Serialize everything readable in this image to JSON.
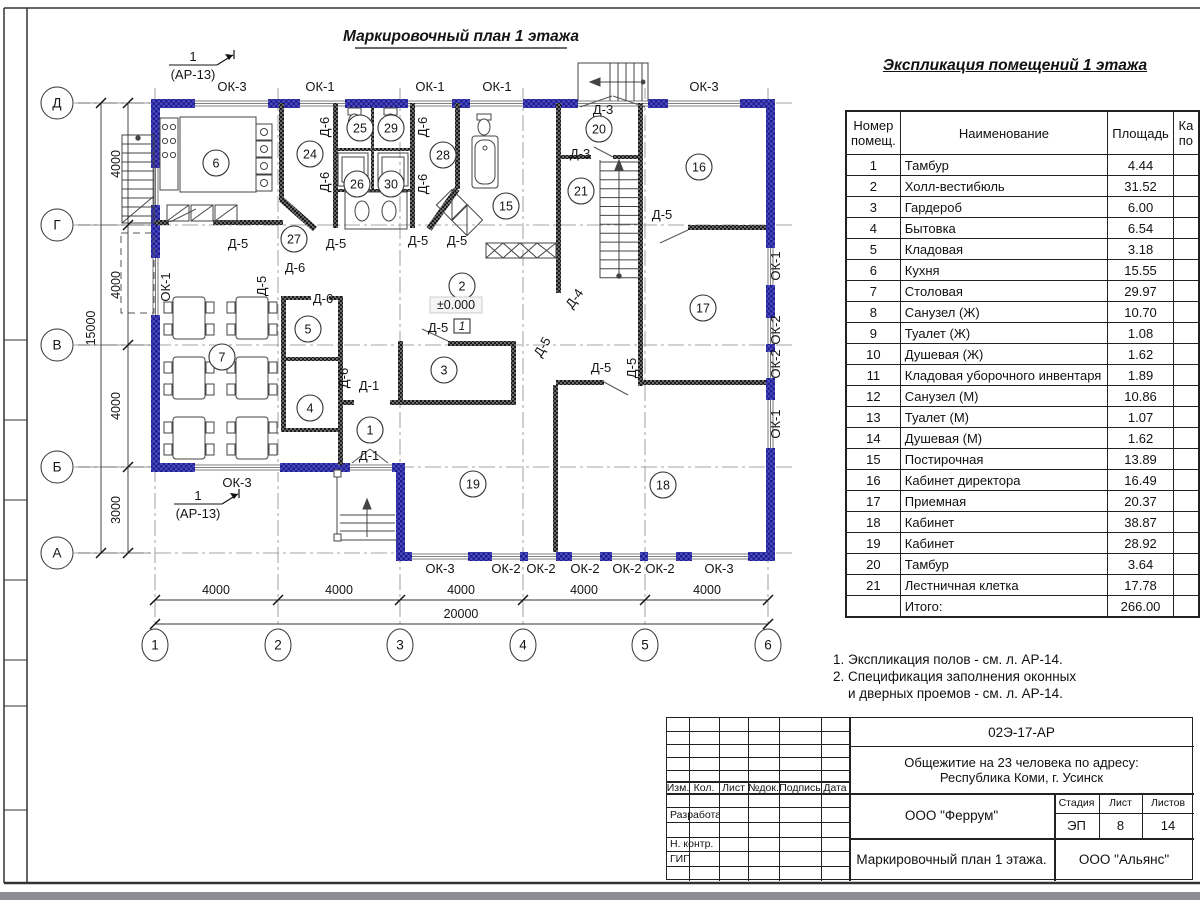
{
  "plan": {
    "title": "Маркировочный план 1 этажа",
    "section_markers": [
      {
        "num": "1",
        "ref": "(АР-13)",
        "x": 193,
        "y": 58
      },
      {
        "num": "1",
        "ref": "(АР-13)",
        "x": 198,
        "y": 497
      }
    ],
    "elevation_mark": {
      "text": "±0.000",
      "x": 456,
      "y": 309
    },
    "floor_number_box": {
      "text": "1",
      "x": 462,
      "y": 330
    },
    "axes_rows": [
      {
        "label": "Д",
        "y": 103
      },
      {
        "label": "Г",
        "y": 225
      },
      {
        "label": "В",
        "y": 345
      },
      {
        "label": "Б",
        "y": 467
      },
      {
        "label": "А",
        "y": 553
      }
    ],
    "axes_cols": [
      {
        "label": "1",
        "x": 155
      },
      {
        "label": "2",
        "x": 278
      },
      {
        "label": "3",
        "x": 400
      },
      {
        "label": "4",
        "x": 523
      },
      {
        "label": "5",
        "x": 645
      },
      {
        "label": "6",
        "x": 768
      }
    ],
    "dims_left": [
      {
        "text": "4000",
        "y": 164
      },
      {
        "text": "4000",
        "y": 285
      },
      {
        "text": "4000",
        "y": 406
      },
      {
        "text": "3000",
        "y": 510
      }
    ],
    "dim_left_total": {
      "text": "15000",
      "y": 328
    },
    "dims_bottom": [
      {
        "text": "4000",
        "x": 216
      },
      {
        "text": "4000",
        "x": 339
      },
      {
        "text": "4000",
        "x": 461
      },
      {
        "text": "4000",
        "x": 584
      },
      {
        "text": "4000",
        "x": 707
      }
    ],
    "dim_bottom_total": {
      "text": "20000",
      "x": 461
    },
    "window_labels": [
      {
        "text": "ОК-3",
        "x": 232,
        "y": 91,
        "r": 0
      },
      {
        "text": "ОК-1",
        "x": 320,
        "y": 91,
        "r": 0
      },
      {
        "text": "ОК-1",
        "x": 430,
        "y": 91,
        "r": 0
      },
      {
        "text": "ОК-1",
        "x": 497,
        "y": 91,
        "r": 0
      },
      {
        "text": "ОК-3",
        "x": 704,
        "y": 91,
        "r": 0
      },
      {
        "text": "ОК-3",
        "x": 237,
        "y": 487,
        "r": 0
      },
      {
        "text": "ОК-3",
        "x": 440,
        "y": 573,
        "r": 0
      },
      {
        "text": "ОК-2",
        "x": 506,
        "y": 573,
        "r": 0
      },
      {
        "text": "ОК-2",
        "x": 541,
        "y": 573,
        "r": 0
      },
      {
        "text": "ОК-2",
        "x": 585,
        "y": 573,
        "r": 0
      },
      {
        "text": "ОК-2",
        "x": 627,
        "y": 573,
        "r": 0
      },
      {
        "text": "ОК-2",
        "x": 660,
        "y": 573,
        "r": 0
      },
      {
        "text": "ОК-3",
        "x": 719,
        "y": 573,
        "r": 0
      },
      {
        "text": "ОК-1",
        "x": 170,
        "y": 287,
        "r": -90
      },
      {
        "text": "ОК-1",
        "x": 780,
        "y": 266,
        "r": -90
      },
      {
        "text": "ОК-2",
        "x": 780,
        "y": 330,
        "r": -90
      },
      {
        "text": "ОК-2",
        "x": 780,
        "y": 364,
        "r": -90
      },
      {
        "text": "ОК-1",
        "x": 780,
        "y": 424,
        "r": -90
      }
    ],
    "door_labels": [
      {
        "text": "Д-6",
        "x": 329,
        "y": 127,
        "r": -90
      },
      {
        "text": "Д-6",
        "x": 427,
        "y": 127,
        "r": -90
      },
      {
        "text": "Д-6",
        "x": 329,
        "y": 182,
        "r": -90
      },
      {
        "text": "Д-6",
        "x": 427,
        "y": 184,
        "r": -90
      },
      {
        "text": "Д-3",
        "x": 603,
        "y": 114,
        "r": 0
      },
      {
        "text": "Д-3",
        "x": 580,
        "y": 158,
        "r": 0
      },
      {
        "text": "Д-5",
        "x": 662,
        "y": 219,
        "r": 0
      },
      {
        "text": "Д-5",
        "x": 238,
        "y": 248,
        "r": 0
      },
      {
        "text": "Д-5",
        "x": 336,
        "y": 248,
        "r": 0
      },
      {
        "text": "Д-5",
        "x": 418,
        "y": 245,
        "r": 0
      },
      {
        "text": "Д-5",
        "x": 457,
        "y": 245,
        "r": 0
      },
      {
        "text": "Д-6",
        "x": 295,
        "y": 272,
        "r": 0
      },
      {
        "text": "Д-5",
        "x": 266,
        "y": 286,
        "r": -90
      },
      {
        "text": "Д-6",
        "x": 323,
        "y": 303,
        "r": 0
      },
      {
        "text": "Д-6",
        "x": 348,
        "y": 378,
        "r": -90
      },
      {
        "text": "Д-1",
        "x": 369,
        "y": 390,
        "r": 0
      },
      {
        "text": "Д-1",
        "x": 369,
        "y": 460,
        "r": 0
      },
      {
        "text": "Д-5",
        "x": 438,
        "y": 332,
        "r": 0
      },
      {
        "text": "Д-4",
        "x": 578,
        "y": 301,
        "r": -55
      },
      {
        "text": "Д-5",
        "x": 546,
        "y": 349,
        "r": -60
      },
      {
        "text": "Д-5",
        "x": 601,
        "y": 372,
        "r": 0
      },
      {
        "text": "Д-5",
        "x": 636,
        "y": 368,
        "r": -90
      }
    ],
    "room_markers": [
      {
        "n": "6",
        "x": 216,
        "y": 163
      },
      {
        "n": "24",
        "x": 310,
        "y": 154
      },
      {
        "n": "25",
        "x": 360,
        "y": 128
      },
      {
        "n": "29",
        "x": 391,
        "y": 128
      },
      {
        "n": "26",
        "x": 357,
        "y": 184
      },
      {
        "n": "30",
        "x": 391,
        "y": 184
      },
      {
        "n": "28",
        "x": 443,
        "y": 155
      },
      {
        "n": "27",
        "x": 294,
        "y": 239
      },
      {
        "n": "15",
        "x": 506,
        "y": 206
      },
      {
        "n": "20",
        "x": 599,
        "y": 129
      },
      {
        "n": "21",
        "x": 581,
        "y": 191
      },
      {
        "n": "16",
        "x": 699,
        "y": 167
      },
      {
        "n": "17",
        "x": 703,
        "y": 308
      },
      {
        "n": "7",
        "x": 222,
        "y": 357
      },
      {
        "n": "5",
        "x": 308,
        "y": 329
      },
      {
        "n": "4",
        "x": 310,
        "y": 408
      },
      {
        "n": "2",
        "x": 462,
        "y": 286
      },
      {
        "n": "3",
        "x": 444,
        "y": 370
      },
      {
        "n": "1",
        "x": 370,
        "y": 430
      },
      {
        "n": "19",
        "x": 473,
        "y": 484
      },
      {
        "n": "18",
        "x": 663,
        "y": 485
      }
    ]
  },
  "schedule": {
    "title": "Экспликация помещений 1 этажа",
    "col_number_l1": "Номер",
    "col_number_l2": "помещ.",
    "col_name": "Наименование",
    "col_area": "Площадь",
    "col_cut_l1": "Ка",
    "col_cut_l2": "по",
    "rows": [
      {
        "n": "1",
        "name": "Тамбур",
        "area": "4.44"
      },
      {
        "n": "2",
        "name": "Холл-вестибюль",
        "area": "31.52"
      },
      {
        "n": "3",
        "name": "Гардероб",
        "area": "6.00"
      },
      {
        "n": "4",
        "name": "Бытовка",
        "area": "6.54"
      },
      {
        "n": "5",
        "name": "Кладовая",
        "area": "3.18"
      },
      {
        "n": "6",
        "name": "Кухня",
        "area": "15.55"
      },
      {
        "n": "7",
        "name": "Столовая",
        "area": "29.97"
      },
      {
        "n": "8",
        "name": "Санузел (Ж)",
        "area": "10.70"
      },
      {
        "n": "9",
        "name": "Туалет (Ж)",
        "area": "1.08"
      },
      {
        "n": "10",
        "name": "Душевая (Ж)",
        "area": "1.62"
      },
      {
        "n": "11",
        "name": "Кладовая уборочного инвентаря",
        "area": "1.89"
      },
      {
        "n": "12",
        "name": "Санузел (М)",
        "area": "10.86"
      },
      {
        "n": "13",
        "name": "Туалет (М)",
        "area": "1.07"
      },
      {
        "n": "14",
        "name": "Душевая (М)",
        "area": "1.62"
      },
      {
        "n": "15",
        "name": "Постирочная",
        "area": "13.89"
      },
      {
        "n": "16",
        "name": "Кабинет директора",
        "area": "16.49"
      },
      {
        "n": "17",
        "name": "Приемная",
        "area": "20.37"
      },
      {
        "n": "18",
        "name": "Кабинет",
        "area": "38.87"
      },
      {
        "n": "19",
        "name": "Кабинет",
        "area": "28.92"
      },
      {
        "n": "20",
        "name": "Тамбур",
        "area": "3.64"
      },
      {
        "n": "21",
        "name": "Лестничная клетка",
        "area": "17.78"
      }
    ],
    "total_label": "Итого:",
    "total_value": "266.00"
  },
  "notes": {
    "line1": "1. Экспликация полов - см. л. АР-14.",
    "line2": "2. Спецификация заполнения оконных",
    "line3": "и дверных проемов - см. л. АР-14."
  },
  "titleblock": {
    "doc_number": "02Э-17-АР",
    "project_line1": "Общежитие на 23 человека по адресу:",
    "project_line2": "Республика Коми, г. Усинск",
    "rev_cols": [
      "Изм.",
      "Кол.",
      "Лист",
      "№док.",
      "Подпись",
      "Дата"
    ],
    "role_developer": "Разработал",
    "role_ncontrol": "Н. контр.",
    "role_gip": "ГИП",
    "org_designer": "ООО \"Феррум\"",
    "stage_label": "Стадия",
    "sheet_label": "Лист",
    "sheets_label": "Листов",
    "stage_value": "ЭП",
    "sheet_value": "8",
    "sheets_value": "14",
    "drawing_name": "Маркировочный план 1 этажа.",
    "org_contractor": "ООО \"Альянс\""
  },
  "colors": {
    "wall_blue": "#3d3db5",
    "wall_blue_dark": "#1d1d8f",
    "wall_dark": "#3a3a3a",
    "line": "#333333"
  }
}
